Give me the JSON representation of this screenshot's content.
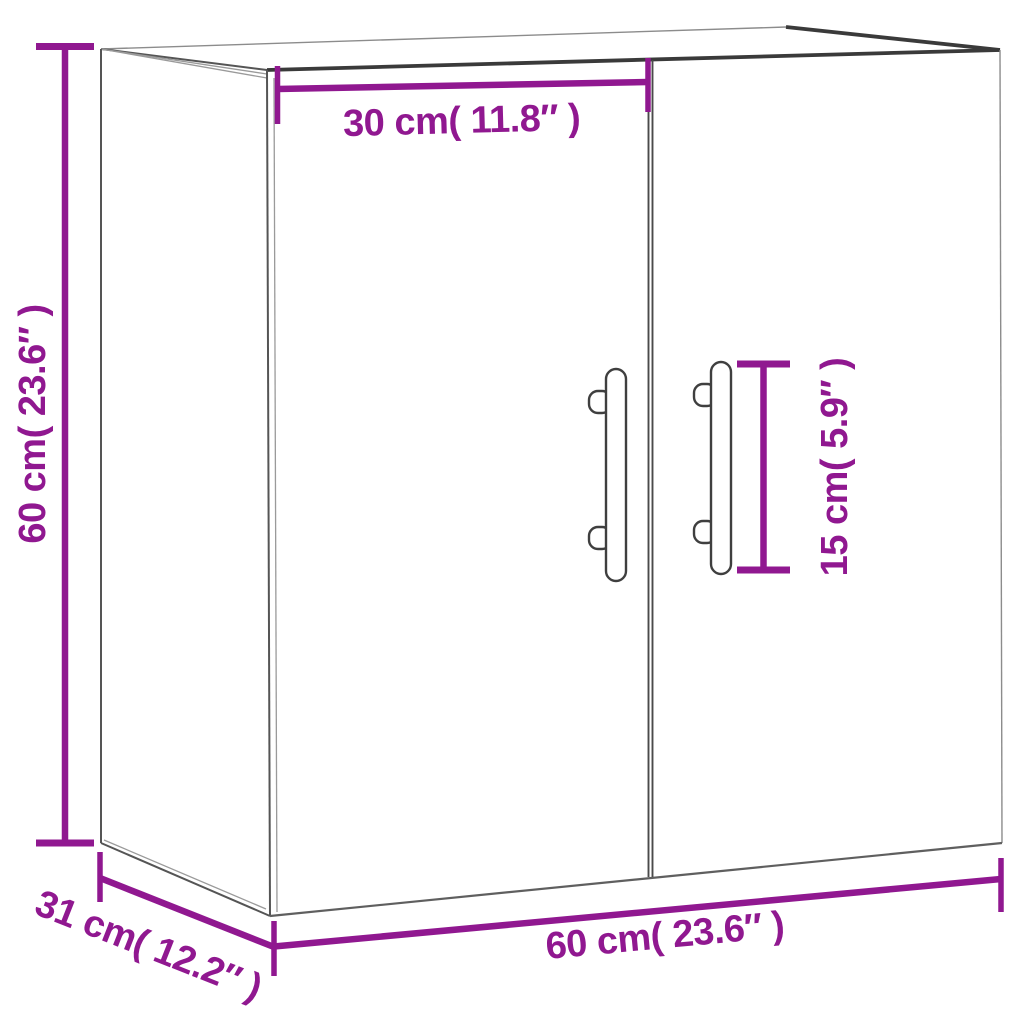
{
  "diagram": {
    "kind": "product-dimension-diagram",
    "product": "wall cabinet with two doors and bar handles",
    "accent_color": "#901890",
    "outline_color": "#3a3a3a",
    "background_color": "#ffffff",
    "labels": {
      "door_width": "30 cm( 11.8″ )",
      "height": "60 cm( 23.6″ )",
      "handle_length": "15 cm( 5.9″ )",
      "depth": "31 cm( 12.2″ )",
      "width": "60 cm( 23.6″ )"
    },
    "dimensions": [
      {
        "name": "door width",
        "cm": 30,
        "inches": 11.8
      },
      {
        "name": "height",
        "cm": 60,
        "inches": 23.6
      },
      {
        "name": "handle length",
        "cm": 15,
        "inches": 5.9
      },
      {
        "name": "depth",
        "cm": 31,
        "inches": 12.2
      },
      {
        "name": "width",
        "cm": 60,
        "inches": 23.6
      }
    ]
  }
}
